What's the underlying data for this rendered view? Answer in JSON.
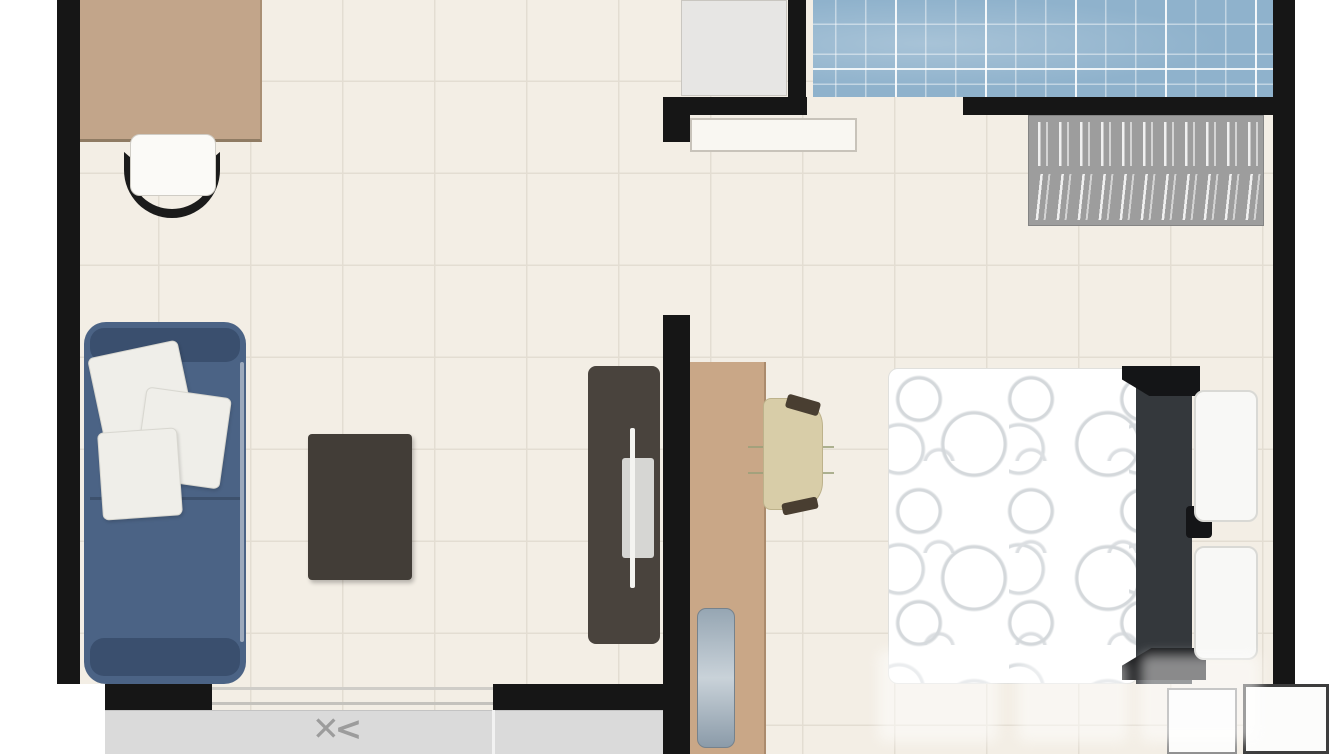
{
  "symbols": {
    "sliding_door": "✕<"
  },
  "palette": {
    "wall": "#161616",
    "floor": "#f3eee5",
    "floor_grid": "#e3ddd2",
    "balcony": "#dadada",
    "wood_counter": "#c2a58a",
    "wood_desk": "#c9a787",
    "sofa_body": "#4b6385",
    "sofa_dark": "#3a4f6e",
    "pillow": "#efeee9",
    "coffee_table": "#423d37",
    "tv_stand": "#49433d",
    "tv_screen": "#d6d6d3",
    "desk_chair": "#d8cda8",
    "desk_chair_accent": "#493e31",
    "bed_pattern": "#d4d8db",
    "headboard": "#34383c",
    "bath_tile": "#8fb2cc",
    "wardrobe": "#9d9d9d",
    "nightstand_border": "#3d3d3d",
    "door_symbol": "#9c9c9c",
    "outline": "#c8c3ba"
  },
  "legend": {
    "figure": "apartment-floor-plan-top-view",
    "elements": [
      "kitchen-counter",
      "dining-chair",
      "sofa",
      "throw-pillows",
      "coffee-table",
      "tv-stand",
      "interior-walls",
      "utility-box",
      "open-door-leaf",
      "bathroom-tiled-floor",
      "wardrobe-with-hanging-clothes",
      "desk",
      "desk-chair",
      "desk-device",
      "double-bed",
      "headboard",
      "bed-pillows",
      "nightstands",
      "balcony",
      "sliding-door",
      "watermark"
    ]
  }
}
